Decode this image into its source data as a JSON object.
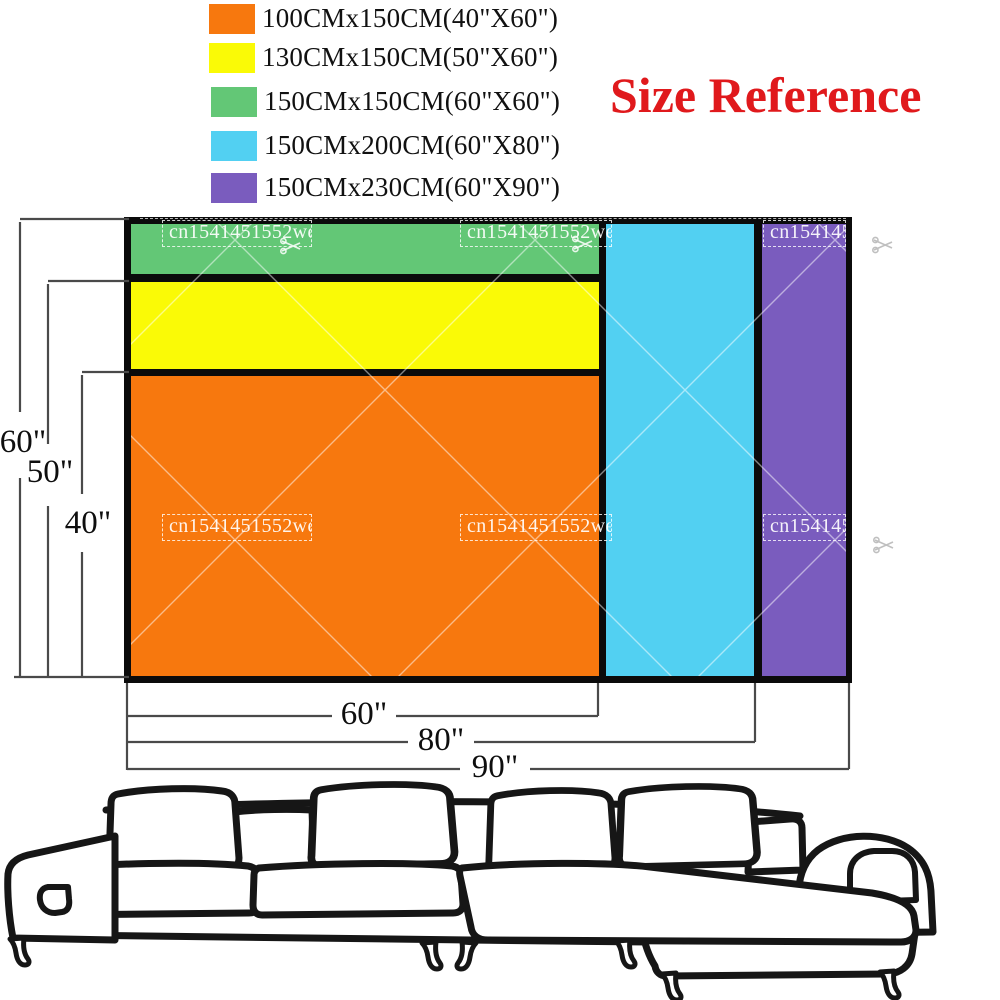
{
  "title": {
    "text": "Size Reference",
    "color": "#e0191c"
  },
  "legend": {
    "items": [
      {
        "id": "orange",
        "swatch_color": "#f7780e",
        "label": "100CMx150CM(40\"X60\")"
      },
      {
        "id": "yellow",
        "swatch_color": "#fafa06",
        "label": "130CMx150CM(50\"X60\")"
      },
      {
        "id": "green",
        "swatch_color": "#63c776",
        "label": "150CMx150CM(60\"X60\")"
      },
      {
        "id": "cyan",
        "swatch_color": "#52d0f2",
        "label": "150CMx200CM(60\"X80\")"
      },
      {
        "id": "purple",
        "swatch_color": "#7a5cbe",
        "label": "150CMx230CM(60\"X90\")"
      }
    ]
  },
  "diagram": {
    "watermark_text": "cn1541451552wedk",
    "left_dimensions": [
      "60\"",
      "50\"",
      "40\""
    ],
    "bottom_dimensions": [
      "60\"",
      "80\"",
      "90\""
    ],
    "regions": [
      {
        "name": "orange-rect",
        "size_label": "100CMx150CM(40\"X60\")"
      },
      {
        "name": "yellow-strip",
        "size_label": "130CMx150CM(50\"X60\")"
      },
      {
        "name": "green-strip",
        "size_label": "150CMx150CM(60\"X60\")"
      },
      {
        "name": "cyan-column",
        "size_label": "150CMx200CM(60\"X80\")"
      },
      {
        "name": "purple-column",
        "size_label": "150CMx230CM(60\"X90\")"
      }
    ],
    "line_color": "#4a4a4a",
    "border_color": "#0b0b0b"
  }
}
